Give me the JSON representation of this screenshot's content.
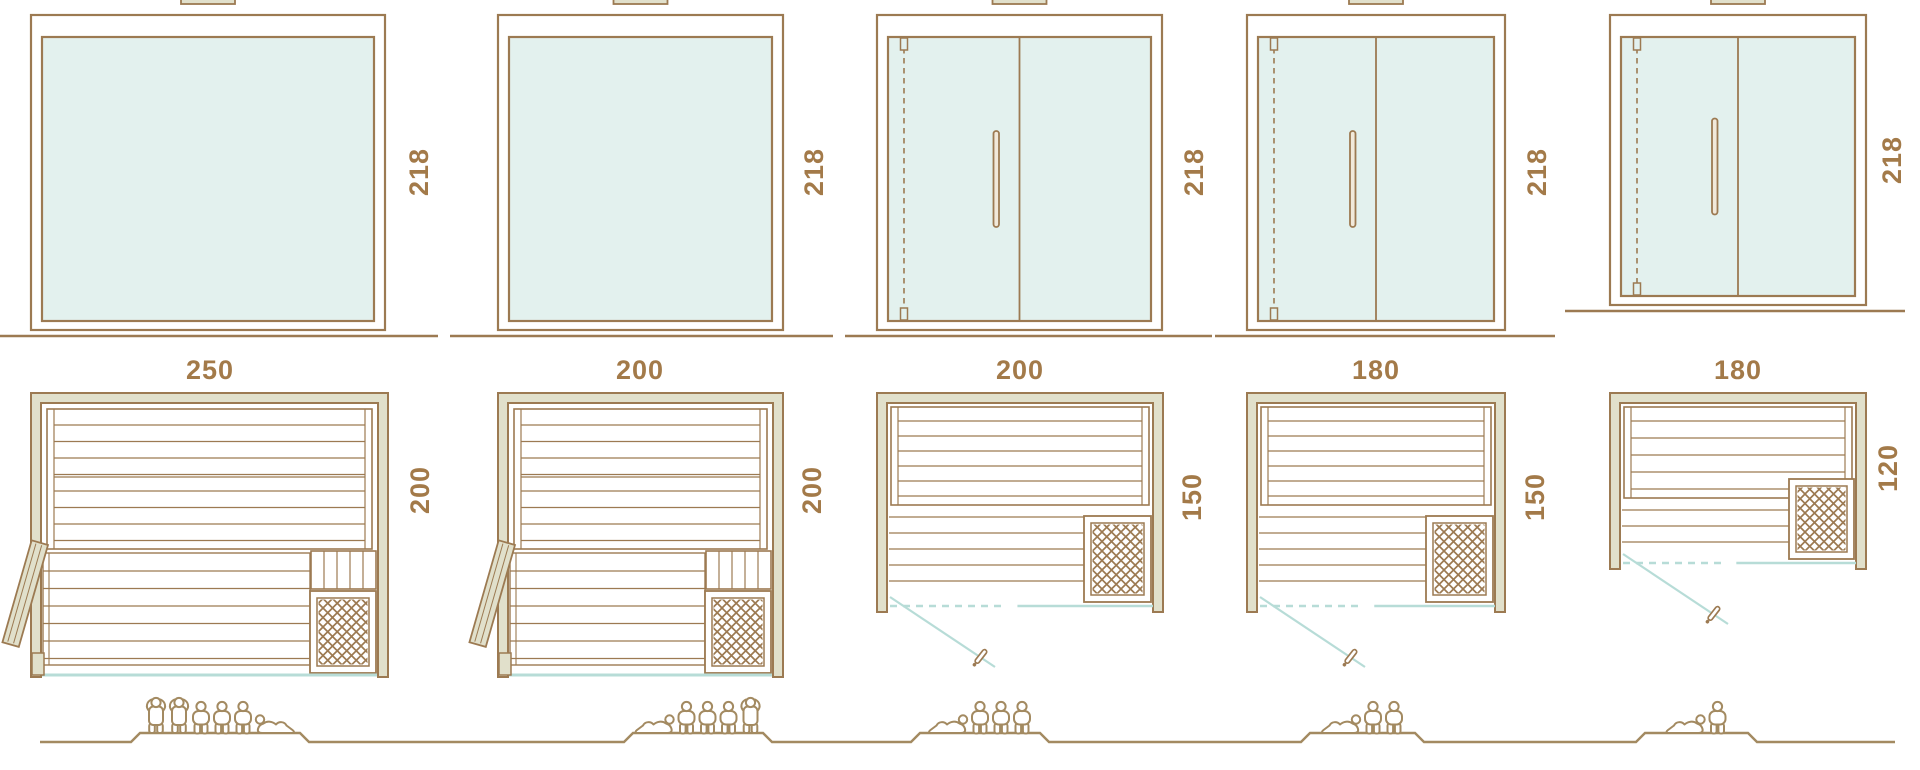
{
  "palette": {
    "line_brown": "#9c7a52",
    "label_brown": "#a37a49",
    "glass_fill": "#e3f1ee",
    "wall_fill": "#e1e0cb",
    "glass_line_teal": "#b7dcd7",
    "figure_tan": "#a38a61",
    "handle_fill": "#f1e9da"
  },
  "columns": [
    {
      "height_label": "218",
      "width_label": "250",
      "depth_label": "200",
      "front": "fixed-glass",
      "door": "wood-hinged",
      "heater": true,
      "capacity": 6,
      "people": [
        "standing",
        "standing",
        "seated",
        "seated",
        "seated",
        "reclining"
      ]
    },
    {
      "height_label": "218",
      "width_label": "200",
      "depth_label": "200",
      "front": "fixed-glass",
      "door": "wood-hinged",
      "heater": true,
      "capacity": 5,
      "people": [
        "reclining",
        "seated",
        "seated",
        "seated",
        "standing"
      ]
    },
    {
      "height_label": "218",
      "width_label": "200",
      "depth_label": "150",
      "front": "glass-double-door",
      "door": "glass-hinged",
      "heater": true,
      "capacity": 4,
      "people": [
        "reclining",
        "seated",
        "seated",
        "seated"
      ]
    },
    {
      "height_label": "218",
      "width_label": "180",
      "depth_label": "150",
      "front": "glass-double-door",
      "door": "glass-hinged",
      "heater": true,
      "capacity": 3,
      "people": [
        "reclining",
        "seated",
        "seated"
      ]
    },
    {
      "height_label": "218",
      "width_label": "180",
      "depth_label": "120",
      "front": "glass-double-door",
      "door": "glass-hinged",
      "heater": true,
      "capacity": 2,
      "people": [
        "reclining",
        "seated"
      ]
    }
  ]
}
